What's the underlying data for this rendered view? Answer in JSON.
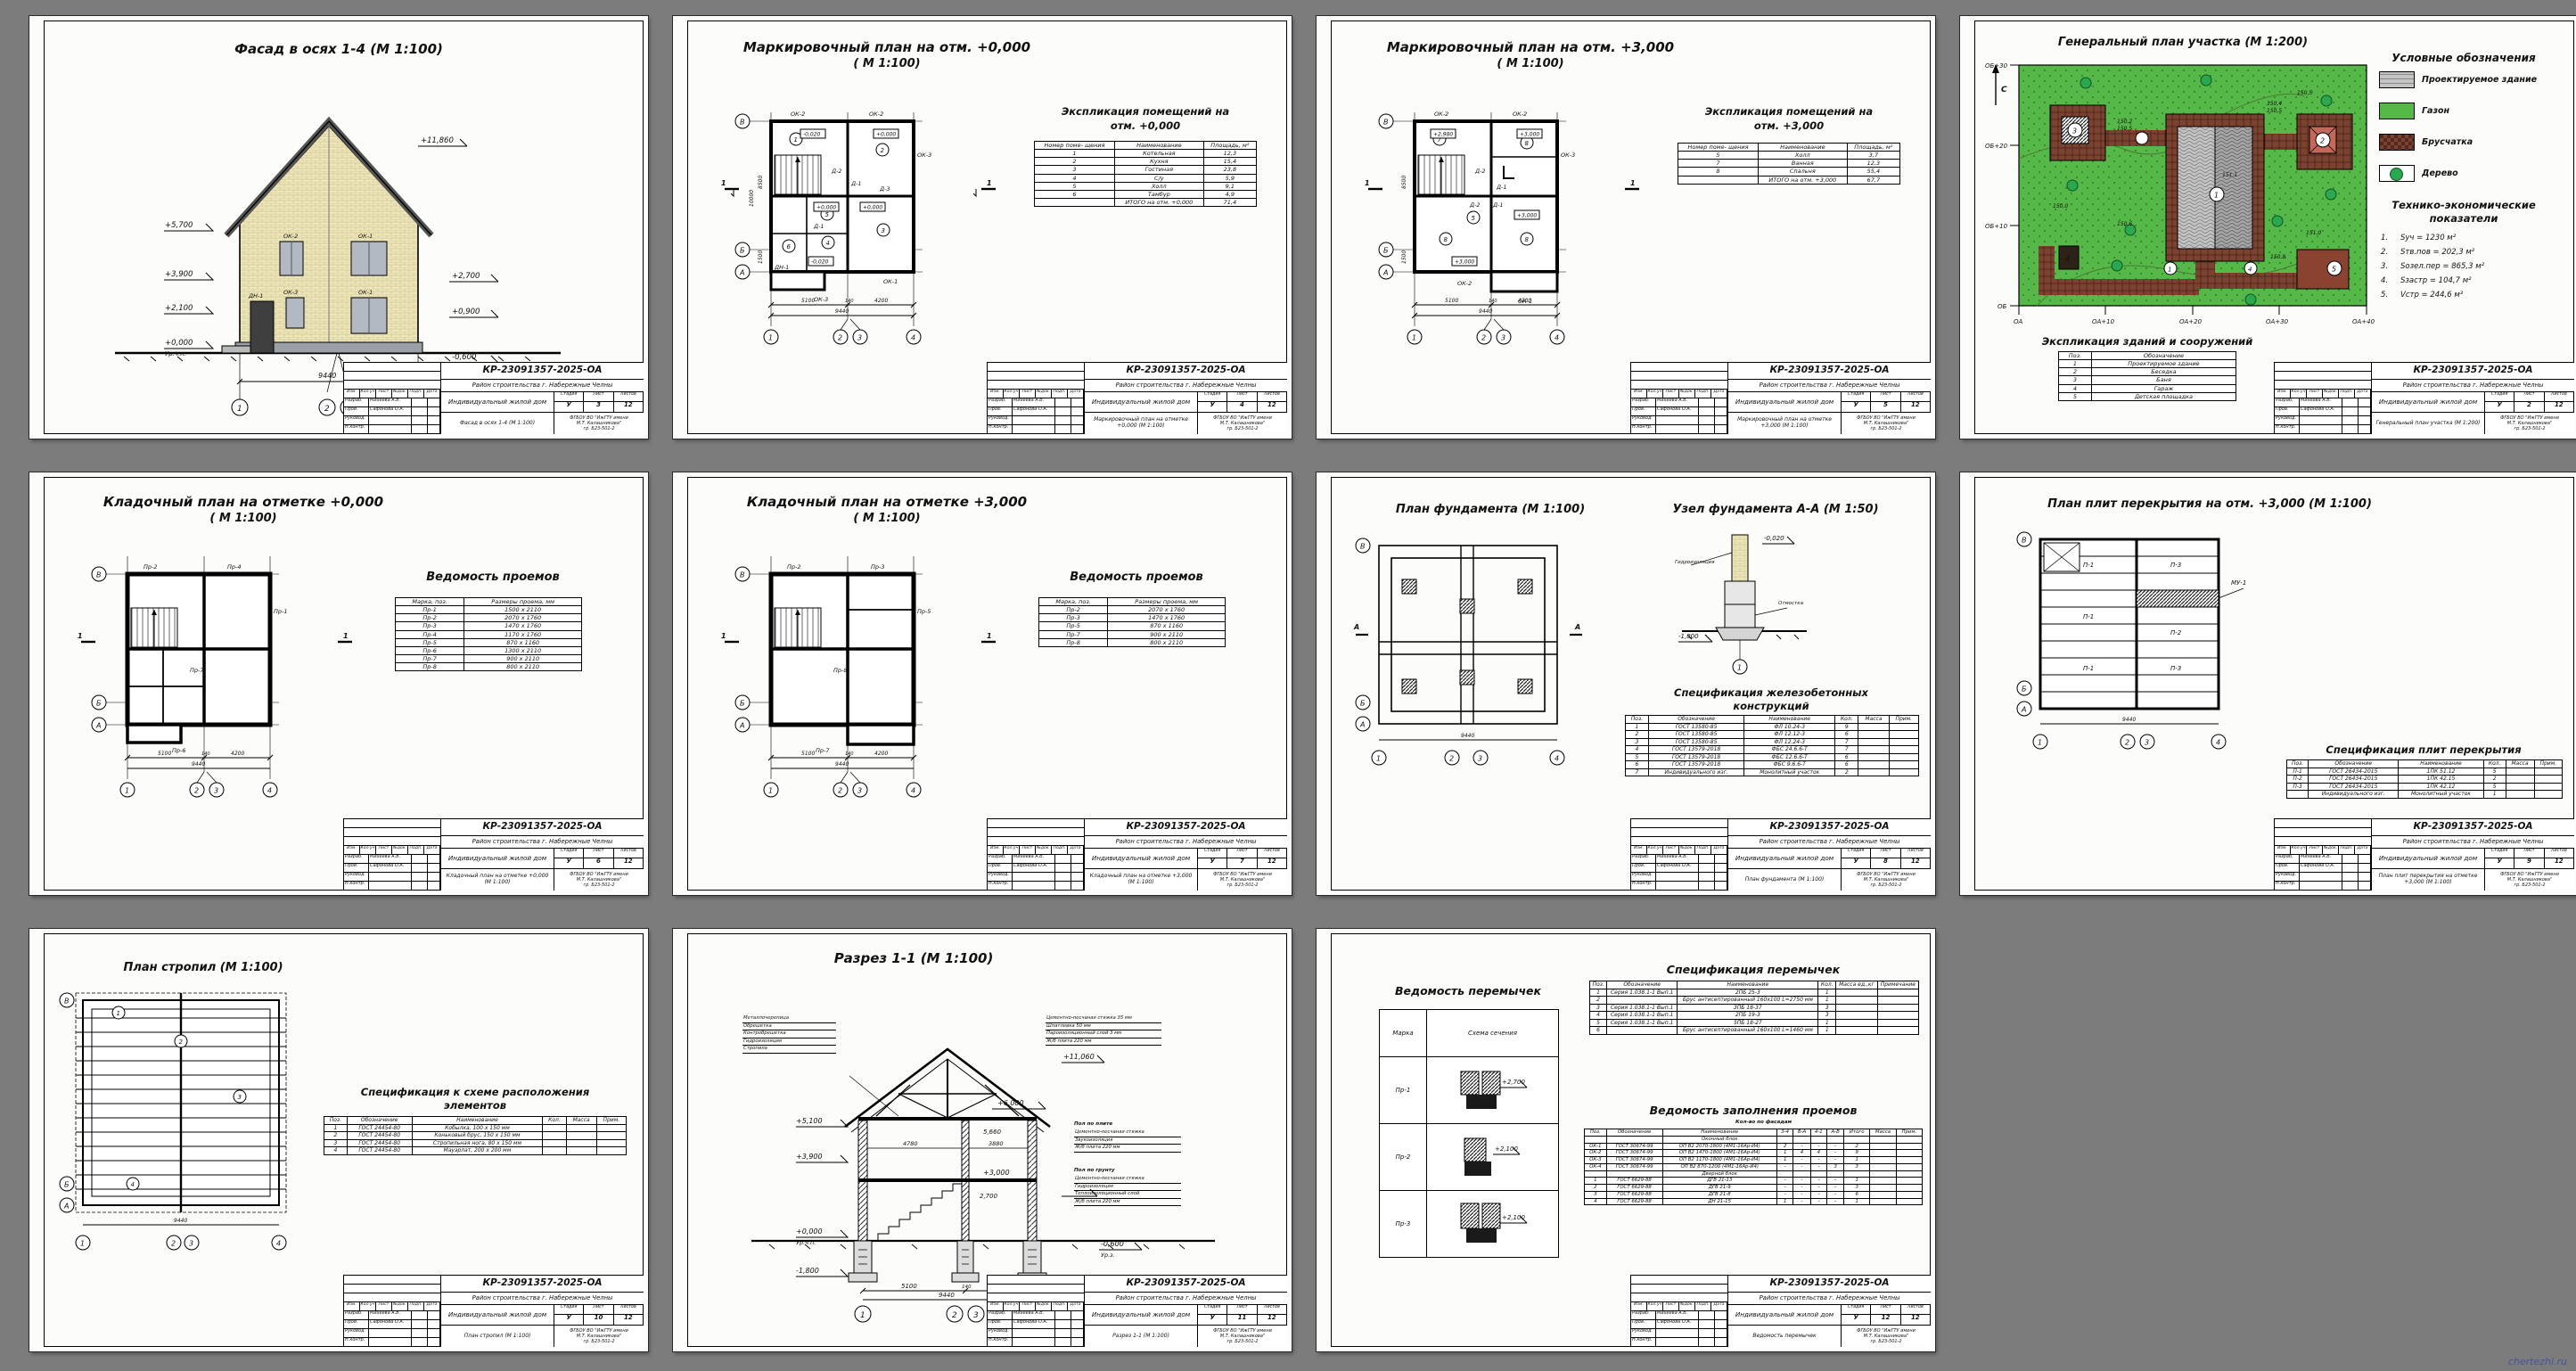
{
  "page": {
    "watermark": "chertezhi.ru",
    "bg": "#7c7c7c",
    "colors": {
      "lawn": "#56b848",
      "paver": "#7a4230",
      "tree": "#2aa84e",
      "brick": "#ece5b8",
      "roof": "#c6c6c6",
      "window": "#b3b9c2"
    }
  },
  "stampCommon": {
    "code": "КР-23091357-2025-ОА",
    "district": "Район строительства г. Набережные Челны",
    "object": "Индивидуальный жилой дом",
    "stage_h": "Стадия",
    "list_h": "Лист",
    "lists_h": "Листов",
    "stage": "У",
    "total": "12",
    "org1": "ФГБОУ ВО \"ИжГТУ имени",
    "org2": "М.Т. Калашникова\"",
    "org3": "гр. Б23-501-2",
    "rev_cols": [
      "Изм.",
      "Кол.уч",
      "Лист",
      "№док.",
      "Подп.",
      "Дата"
    ],
    "roles": [
      {
        "r": "Разраб.",
        "n": "Михеева А.В."
      },
      {
        "r": "Пров.",
        "n": "Сафонова О.А."
      },
      {
        "r": "Руковод.",
        "n": ""
      },
      {
        "r": "Н.контр.",
        "n": ""
      }
    ]
  },
  "sheets": [
    {
      "title": "Фасад в осях 1-4 (М 1:100)",
      "marks": {
        "ridge": "+11,860",
        "eave": "+5,700",
        "m39": "+3,900",
        "m21": "+2,100",
        "zero": "+0,000",
        "urchp": "Ур.ч.п.",
        "m27": "+2,700",
        "m09": "+0,900",
        "m06": "-0,600",
        "urz": "Ур.з."
      },
      "win": {
        "w1": "ОК-2",
        "w2": "ОК-1",
        "w3": "ОК-3",
        "w4": "ОК-1",
        "door": "ДН-1"
      },
      "dim_total": "9440",
      "axes": [
        "1",
        "2",
        "3",
        "4"
      ],
      "stamp": {
        "name": "Фасад в осях 1-4 (М 1:100)",
        "list": "3"
      }
    },
    {
      "title1": "Маркировочный план на отм. +0,000",
      "title2": "( М 1:100)",
      "expl_title1": "Экспликация помещений на",
      "expl_title2": "отм. +0,000",
      "expl_head": [
        "Номер поме- щения",
        "Наименование",
        "Площадь, м²"
      ],
      "expl_rows": [
        [
          "1",
          "Котельная",
          "12,3"
        ],
        [
          "2",
          "Кухня",
          "15,4"
        ],
        [
          "3",
          "Гостиная",
          "23,8"
        ],
        [
          "4",
          "С/у",
          "5,9"
        ],
        [
          "5",
          "Холл",
          "9,1"
        ],
        [
          "6",
          "Тамбур",
          "4,9"
        ],
        [
          "",
          "ИТОГО на отм. +0,000",
          "71,4"
        ]
      ],
      "plan": {
        "lv1": "-0,020",
        "lv2": "+0,000",
        "lv3": "+0,000",
        "lv4": "+0,000",
        "lv5": "-0,020",
        "d1": "Д-1",
        "d2": "Д-2",
        "d3": "Д-3",
        "d4": "Д-1",
        "dn": "ДН-1",
        "ok1": "ОК-1",
        "ok2": "ОК-2",
        "ok2b": "ОК-2",
        "ok3": "ОК-3",
        "ok3b": "ОК-3",
        "rooms": [
          "1",
          "2",
          "3",
          "4",
          "5",
          "6"
        ],
        "sec": "1"
      },
      "dims": {
        "d1": "5100",
        "d2": "140",
        "d3": "4200",
        "total": "9440",
        "v1": "8500",
        "v2": "1500",
        "vt": "10000"
      },
      "axes": {
        "h": [
          "1",
          "2",
          "3",
          "4"
        ],
        "v": [
          "В",
          "Б",
          "А"
        ]
      },
      "stamp": {
        "name": "Маркировочный план на отметке +0,000 (М 1:100)",
        "list": "4"
      }
    },
    {
      "title1": "Маркировочный план на отм. +3,000",
      "title2": "( М 1:100)",
      "expl_title1": "Экспликация помещений на",
      "expl_title2": "отм. +3,000",
      "expl_head": [
        "Номер поме- щения",
        "Наименование",
        "Площадь, м²"
      ],
      "expl_rows": [
        [
          "5",
          "Холл",
          "3,7"
        ],
        [
          "7",
          "Ванная",
          "12,3"
        ],
        [
          "8",
          "Спальня",
          "55,4"
        ],
        [
          "",
          "ИТОГО на отм. +3,000",
          "67,7"
        ]
      ],
      "plan": {
        "lv1": "+2,980",
        "lv2": "+3,000",
        "lv3": "+3,000",
        "lv4": "+3,000",
        "d1": "Д-1",
        "d2": "Д-2",
        "d3": "Д-2",
        "d4": "Д-1",
        "ok1": "ОК-1",
        "ok2": "ОК-2",
        "ok2b": "ОК-2",
        "ok3": "ОК-3",
        "rooms": [
          "7",
          "8",
          "5",
          "8",
          "8"
        ],
        "sec": "1"
      },
      "dims": {
        "d1": "5100",
        "d2": "140",
        "d3": "4200",
        "total": "9440",
        "v1": "8500",
        "v2": "1500",
        "vt": "10000"
      },
      "axes": {
        "h": [
          "1",
          "2",
          "3",
          "4"
        ],
        "v": [
          "В",
          "Б",
          "А"
        ]
      },
      "stamp": {
        "name": "Маркировочный план на отметке +3,000 (М 1:100)",
        "list": "5"
      }
    },
    {
      "title": "Генеральный план участка (М 1:200)",
      "legend_title": "Условные обозначения",
      "legend": [
        "Проектируемое здание",
        "Газон",
        "Брусчатка",
        "Дерево"
      ],
      "tep_title1": "Технико-экономические",
      "tep_title2": "показатели",
      "tep": [
        [
          "1.",
          "Sуч = 1230 м²"
        ],
        [
          "2.",
          "Sтв.пов = 202,3 м²"
        ],
        [
          "3.",
          "Sозел.пер = 865,3 м²"
        ],
        [
          "4.",
          "Sзастр = 104,7 м²"
        ],
        [
          "5.",
          "Vстр = 244,6 м³"
        ]
      ],
      "expl_title": "Экспликация зданий и сооружений",
      "expl_head": [
        "Поз.",
        "Обозначение"
      ],
      "expl_rows": [
        [
          "1",
          "Проектируемое здание"
        ],
        [
          "2",
          "Беседка"
        ],
        [
          "3",
          "Баня"
        ],
        [
          "4",
          "Гараж"
        ],
        [
          "5",
          "Детская площадка"
        ]
      ],
      "ax_v": [
        "ОБ+30",
        "ОБ+20",
        "ОБ+10",
        "ОБ"
      ],
      "ax_h": [
        "ОА",
        "ОА+10",
        "ОА+20",
        "ОА+30",
        "ОА+40"
      ],
      "north": "С",
      "spots": [
        "150,2",
        "150,5",
        "150,4",
        "150,5",
        "150,0",
        "151,1",
        "150,6",
        "150,8",
        "151,0",
        "150,5"
      ],
      "pos": [
        "1",
        "2",
        "3",
        "4",
        "5"
      ],
      "stamp": {
        "name": "Генеральный план участка (М 1:200)",
        "list": "2"
      }
    },
    {
      "title1": "Кладочный план на отметке +0,000",
      "title2": "( М 1:100)",
      "ved_title": "Ведомость проемов",
      "ved_head": [
        "Марка, поз.",
        "Размеры проема, мм"
      ],
      "ved_rows": [
        [
          "Пр-1",
          "1500 x 2110"
        ],
        [
          "Пр-2",
          "2070 x 1760"
        ],
        [
          "Пр-3",
          "1470 x 1760"
        ],
        [
          "Пр-4",
          "1170 x 1760"
        ],
        [
          "Пр-5",
          "870 x 1160"
        ],
        [
          "Пр-6",
          "1300 x 2110"
        ],
        [
          "Пр-7",
          "900 x 2110"
        ],
        [
          "Пр-8",
          "800 x 2110"
        ]
      ],
      "plan": {
        "t1": "Пр-2",
        "t2": "Пр-4",
        "t3": "Пр-1",
        "t4": "Пр-6",
        "t5": "Пр-7",
        "sec": "1"
      },
      "dims": {
        "d1": "5100",
        "d2": "140",
        "d3": "4200",
        "total": "9440"
      },
      "axes": {
        "h": [
          "1",
          "2",
          "3",
          "4"
        ],
        "v": [
          "В",
          "Б",
          "А"
        ]
      },
      "stamp": {
        "name": "Кладочный план на отметке +0,000 (М 1:100)",
        "list": "6"
      }
    },
    {
      "title1": "Кладочный план на отметке +3,000",
      "title2": "( М 1:100)",
      "ved_title": "Ведомость проемов",
      "ved_head": [
        "Марка, поз.",
        "Размеры проема, мм"
      ],
      "ved_rows": [
        [
          "Пр-2",
          "2070 x 1760"
        ],
        [
          "Пр-3",
          "1470 x 1760"
        ],
        [
          "Пр-5",
          "870 x 1160"
        ],
        [
          "Пр-7",
          "900 x 2110"
        ],
        [
          "Пр-8",
          "800 x 2110"
        ]
      ],
      "plan": {
        "t1": "Пр-2",
        "t2": "Пр-3",
        "t3": "Пр-5",
        "t4": "Пр-7",
        "t5": "Пр-8",
        "sec": "1"
      },
      "dims": {
        "d1": "5100",
        "d2": "140",
        "d3": "4200",
        "total": "9440"
      },
      "axes": {
        "h": [
          "1",
          "2",
          "3",
          "4"
        ],
        "v": [
          "В",
          "Б",
          "А"
        ]
      },
      "stamp": {
        "name": "Кладочный план на отметке +3,000 (М 1:100)",
        "list": "7"
      }
    },
    {
      "title_plan": "План фундамента (М 1:100)",
      "title_node": "Узел фундамента А-А (М 1:50)",
      "spec_title1": "Спецификация железобетонных",
      "spec_title2": "конструкций",
      "spec_head": [
        "Поз.",
        "Обозначение",
        "Наименование",
        "Кол.",
        "Масса",
        "Прим."
      ],
      "spec_rows": [
        [
          "1",
          "ГОСТ 13580-85",
          "ФЛ 10.24-3",
          "9",
          "",
          ""
        ],
        [
          "2",
          "ГОСТ 13580-85",
          "ФЛ 12.12-3",
          "6",
          "",
          ""
        ],
        [
          "3",
          "ГОСТ 13580-85",
          "ФЛ 12.24-3",
          "7",
          "",
          ""
        ],
        [
          "4",
          "ГОСТ 13579-2018",
          "ФБС 24.6.6-Т",
          "7",
          "",
          ""
        ],
        [
          "5",
          "ГОСТ 13579-2018",
          "ФБС 12.6.6-Т",
          "6",
          "",
          ""
        ],
        [
          "6",
          "ГОСТ 13579-2018",
          "ФБС 9.6.6-Т",
          "6",
          "",
          ""
        ],
        [
          "7",
          "Индивидуального изг.",
          "Монолитный участок",
          "2",
          "",
          ""
        ]
      ],
      "node": {
        "m1": "-0,020",
        "m2": "-1,800",
        "lbl1": "Гидроизоляция",
        "lbl2": "Отмостка",
        "ax": "1"
      },
      "secmark": "А",
      "axes": {
        "h": [
          "1",
          "2",
          "3",
          "4"
        ],
        "v": [
          "В",
          "Б",
          "А"
        ]
      },
      "dims": {
        "total": "9440"
      },
      "stamp": {
        "name": "План фундамента (М 1:100)",
        "list": "8"
      }
    },
    {
      "title": "План плит перекрытия на отм. +3,000 (М 1:100)",
      "spec_title": "Спецификация плит перекрытия",
      "spec_head": [
        "Поз.",
        "Обозначение",
        "Наименование",
        "Кол.",
        "Масса",
        "Прим."
      ],
      "spec_rows": [
        [
          "П-1",
          "ГОСТ 26434-2015",
          "1ПК 51.12",
          "5",
          "",
          ""
        ],
        [
          "П-2",
          "ГОСТ 26434-2015",
          "1ПК 42.15",
          "2",
          "",
          ""
        ],
        [
          "П-3",
          "ГОСТ 26434-2015",
          "1ПК 42.12",
          "5",
          "",
          ""
        ],
        [
          "",
          "Индивидуального изг.",
          "Монолитный участок",
          "1",
          "",
          ""
        ]
      ],
      "labels": {
        "a": "П-1",
        "b": "П-1",
        "c": "П-1",
        "d": "П-3",
        "e": "П-2",
        "f": "П-3",
        "mu": "МУ-1"
      },
      "axes": {
        "h": [
          "1",
          "2",
          "3",
          "4"
        ],
        "v": [
          "В",
          "Б",
          "А"
        ]
      },
      "dims": {
        "total": "9440"
      },
      "stamp": {
        "name": "План плит перекрытия на отметке +3,000 (М 1:100)",
        "list": "9"
      }
    },
    {
      "title": "План стропил (М 1:100)",
      "spec_title1": "Спецификация к схеме расположения",
      "spec_title2": "элементов",
      "spec_head": [
        "Поз.",
        "Обозначение",
        "Наименование",
        "Кол.",
        "Масса",
        "Прим."
      ],
      "spec_rows": [
        [
          "1",
          "ГОСТ 24454-80",
          "Кобылка, 100 x 150 мм",
          "",
          "",
          ""
        ],
        [
          "2",
          "ГОСТ 24454-80",
          "Коньковый брус, 150 x 150 мм",
          "",
          "",
          ""
        ],
        [
          "3",
          "ГОСТ 24454-80",
          "Стропильная нога, 80 x 150 мм",
          "",
          "",
          ""
        ],
        [
          "4",
          "ГОСТ 24454-80",
          "Мауэрлат, 200 x 200 мм",
          "",
          "",
          ""
        ]
      ],
      "pos": [
        "1",
        "2",
        "3",
        "4"
      ],
      "axes": {
        "h": [
          "1",
          "2",
          "3",
          "4"
        ],
        "v": [
          "В",
          "Б",
          "А"
        ]
      },
      "dims": {
        "total": "9440"
      },
      "stamp": {
        "name": "План стропил (М 1:100)",
        "list": "10"
      }
    },
    {
      "title": "Разрез 1-1 (М 1:100)",
      "roof_layers": [
        "Металлочерепица",
        "Обрешетка",
        "Контробрешетка",
        "Гидроизоляция",
        "Стропила"
      ],
      "attic_layers": [
        "Цементно-песчаная стяжка 35 мм",
        "Шпатлевка 50 мм",
        "Пароизоляционный слой 3 мм",
        "Ж/б плита 220 мм"
      ],
      "floor2_t": "Пол по плите",
      "floor2_layers": [
        "Цементно-песчаная стяжка",
        "Звукоизоляция",
        "Ж/б плита 220 мм"
      ],
      "floor1_t": "Пол по грунту",
      "floor1_layers": [
        "Цементно-песчаная стяжка",
        "Гидроизоляция",
        "Теплоизоляционный слой",
        "Ж/б плита 220 мм"
      ],
      "marks": {
        "l1": "+5,100",
        "l2": "+3,900",
        "l3": "+0,000",
        "l3b": "Ур.ч.п.",
        "l4": "-1,800",
        "r0": "+11,060",
        "r1": "+6,000",
        "r2": "5,660",
        "r3": "+3,000",
        "r4": "2,700",
        "r5": "-0,600",
        "r5b": "Ур.з."
      },
      "in_dims": {
        "a": "4780",
        "b": "3880"
      },
      "dims": {
        "d1": "5100",
        "d2": "140",
        "d3": "4200",
        "total": "9440"
      },
      "axes": [
        "1",
        "2",
        "3",
        "4"
      ],
      "stamp": {
        "name": "Разрез 1-1 (М 1:100)",
        "list": "11"
      }
    },
    {
      "ved_title": "Ведомость перемычек",
      "ved_head": [
        "Марка",
        "Схема сечения"
      ],
      "lintels": [
        {
          "mark": "Пр-1",
          "level": "+2,700"
        },
        {
          "mark": "Пр-2",
          "level": "+2,100"
        },
        {
          "mark": "Пр-3",
          "level": "+2,100"
        }
      ],
      "spec_title": "Спецификация перемычек",
      "spec_head": [
        "Поз.",
        "Обозначение",
        "Наименование",
        "Кол.",
        "Масса ед.,кг",
        "Примечание"
      ],
      "spec_rows": [
        [
          "1",
          "Серия 1.038.1-1 Вып.1",
          "2ПБ 25-3",
          "1",
          "",
          ""
        ],
        [
          "2",
          "",
          "Брус антисептированный 160x100 L=2750 мм",
          "1",
          "",
          ""
        ],
        [
          "3",
          "Серия 1.038.1-1 Вып.1",
          "3ПБ 18-37",
          "3",
          "",
          ""
        ],
        [
          "4",
          "Серия 1.038.1-1 Вып.1",
          "2ПБ 19-3",
          "3",
          "",
          ""
        ],
        [
          "5",
          "Серия 1.038.1-1 Вып.1",
          "5ПБ 18-27",
          "1",
          "",
          ""
        ],
        [
          "6",
          "",
          "Брус антисептированный 160x100 L=1460 мм",
          "1",
          "",
          ""
        ]
      ],
      "fill_title": "Ведомость заполнения проемов",
      "fill_sub": "Кол-во по фасадам",
      "fill_head": [
        "Поз.",
        "Обозначение",
        "Наименование",
        "3-4",
        "В-А",
        "4-1",
        "А-В",
        "Итого",
        "Масса",
        "Прим."
      ],
      "fill_rows": [
        [
          "",
          "",
          "Оконный блок",
          "",
          "",
          "",
          "",
          "",
          "",
          ""
        ],
        [
          "ОК-1",
          "ГОСТ 30674-99",
          "ОП В2 2070-1800 (4М1-16Ар-И4)",
          "2",
          "-",
          "-",
          "-",
          "2",
          "",
          ""
        ],
        [
          "ОК-2",
          "ГОСТ 30674-99",
          "ОП В2 1470-1800 (4М1-16Ар-И4)",
          "1",
          "4",
          "4",
          "-",
          "9",
          "",
          ""
        ],
        [
          "ОК-3",
          "ГОСТ 30674-99",
          "ОП В2 1170-1800 (4М1-16Ар-И4)",
          "1",
          "-",
          "-",
          "-",
          "1",
          "",
          ""
        ],
        [
          "ОК-4",
          "ГОСТ 30674-99",
          "ОП В2 870-1200 (4М1-16Ар-И4)",
          "-",
          "-",
          "-",
          "3",
          "3",
          "",
          ""
        ],
        [
          "",
          "",
          "Дверной блок",
          "",
          "",
          "",
          "",
          "",
          "",
          ""
        ],
        [
          "1",
          "ГОСТ 6629-88",
          "ДГВ 21-13",
          "-",
          "-",
          "-",
          "-",
          "1",
          "",
          ""
        ],
        [
          "2",
          "ГОСТ 6629-88",
          "ДГВ 21-9",
          "-",
          "-",
          "-",
          "-",
          "3",
          "",
          ""
        ],
        [
          "3",
          "ГОСТ 6629-88",
          "ДГВ 21-8",
          "-",
          "-",
          "-",
          "-",
          "6",
          "",
          ""
        ],
        [
          "4",
          "ГОСТ 6629-88",
          "ДН 21-15",
          "1",
          "-",
          "-",
          "-",
          "1",
          "",
          ""
        ]
      ],
      "stamp": {
        "name": "Ведомость перемычек",
        "list": "12"
      }
    }
  ]
}
